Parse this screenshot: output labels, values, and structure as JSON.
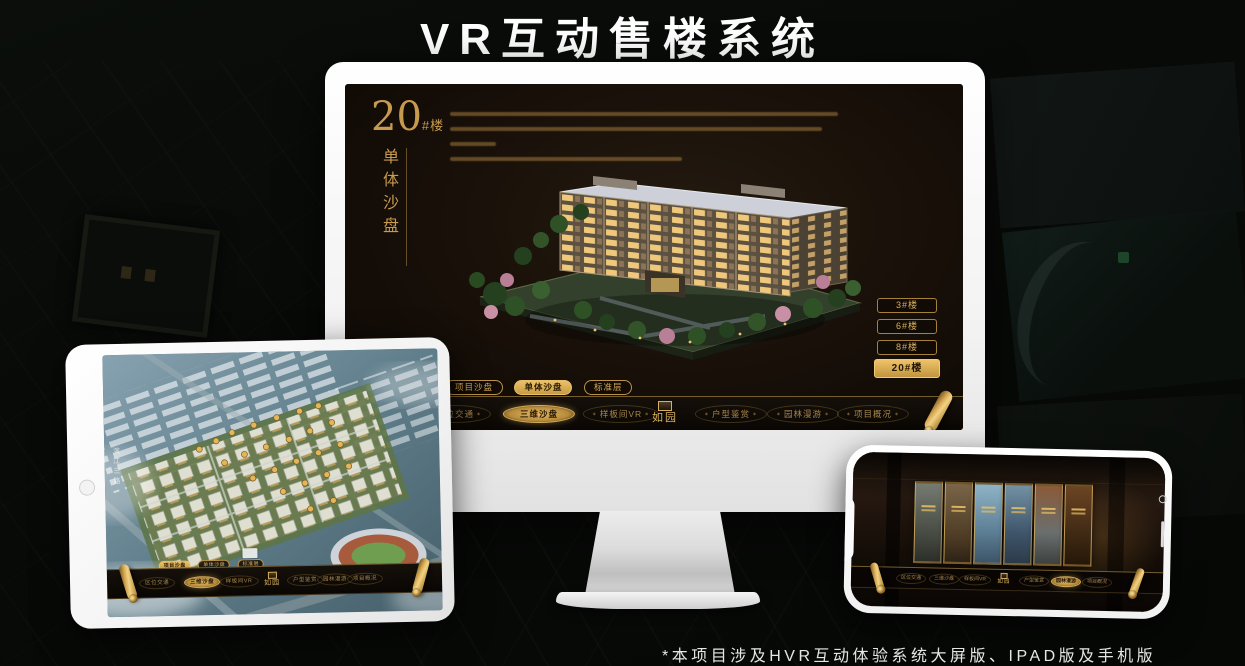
{
  "page": {
    "title": "VR互动售楼系统",
    "footnote": "*本项目涉及HVR互动体验系统大屏版、IPAD版及手机版"
  },
  "colors": {
    "gold_accent": "#d2a955",
    "selected_text": "#241605",
    "screen_bg": "#170f08"
  },
  "brand": {
    "logo_text": "如园"
  },
  "monitor": {
    "headline": {
      "number": "20",
      "suffix": "#楼",
      "subtitle_vertical": "单体沙盘"
    },
    "floor_buttons": [
      {
        "label": "3#楼",
        "selected": false
      },
      {
        "label": "6#楼",
        "selected": false
      },
      {
        "label": "8#楼",
        "selected": false
      },
      {
        "label": "20#楼",
        "selected": true
      }
    ],
    "sub_tabs": [
      {
        "label": "项目沙盘",
        "selected": false
      },
      {
        "label": "单体沙盘",
        "selected": true
      },
      {
        "label": "标准层",
        "selected": false
      }
    ],
    "nav_items": [
      {
        "label": "区位交通",
        "selected": false
      },
      {
        "label": "三维沙盘",
        "selected": true
      },
      {
        "label": "样板间VR",
        "selected": false
      },
      {
        "label": "户型鉴赏",
        "selected": false
      },
      {
        "label": "园林漫游",
        "selected": false
      },
      {
        "label": "项目概况",
        "selected": false
      }
    ]
  },
  "tablet": {
    "road_label": "滨江三路",
    "sub_tabs": [
      {
        "label": "项目沙盘",
        "selected": true
      },
      {
        "label": "单体沙盘",
        "selected": false
      },
      {
        "label": "标准层",
        "selected": false
      }
    ],
    "nav_items": [
      {
        "label": "区位交通",
        "selected": false
      },
      {
        "label": "三维沙盘",
        "selected": true
      },
      {
        "label": "样板间VR",
        "selected": false
      },
      {
        "label": "户型鉴赏",
        "selected": false
      },
      {
        "label": "园林漫游",
        "selected": false
      },
      {
        "label": "项目概况",
        "selected": false
      }
    ]
  },
  "phone": {
    "nav_items": [
      {
        "label": "区位交通",
        "selected": false
      },
      {
        "label": "三维沙盘",
        "selected": false
      },
      {
        "label": "样板间VR",
        "selected": false
      },
      {
        "label": "户型鉴赏",
        "selected": false
      },
      {
        "label": "园林漫游",
        "selected": true
      },
      {
        "label": "项目概况",
        "selected": false
      }
    ]
  }
}
